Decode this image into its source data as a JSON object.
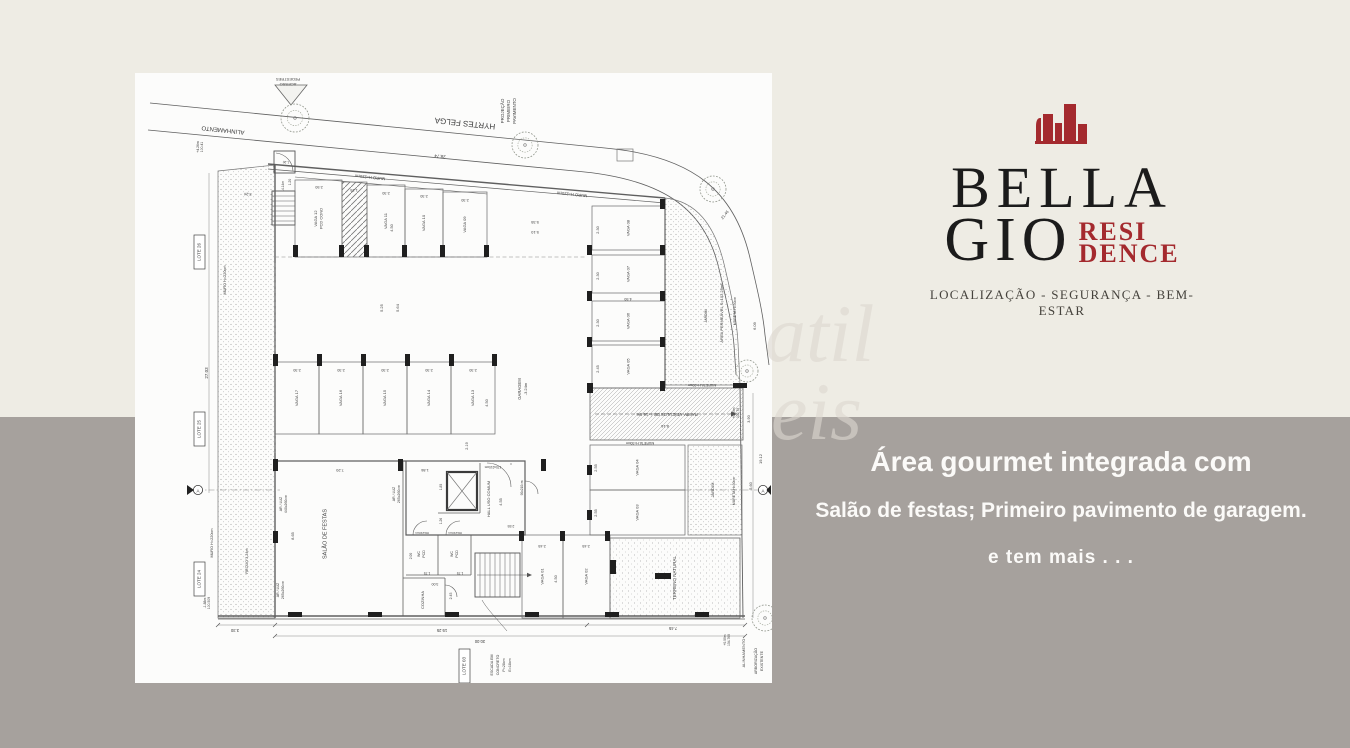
{
  "colors": {
    "bg_top": "#eeece4",
    "bg_bottom": "#a6a19d",
    "accent": "#a42a2e",
    "ink": "#1b1b1b"
  },
  "branding": {
    "name_line1": "BELLA",
    "name_line2": "GIO",
    "suffix_line1": "RESI",
    "suffix_line2": "DENCE",
    "tagline": "LOCALIZAÇÃO - SEGURANÇA - BEM-ESTAR"
  },
  "marketing": {
    "line1": "Área gourmet integrada com",
    "line2": "Salão de festas; Primeiro pavimento de garagem.",
    "line3": "e tem mais . . ."
  },
  "watermark": {
    "part1": "atil",
    "part2": "eis"
  },
  "plan": {
    "street_name": "HYRTES FELGA",
    "stalls": [
      {
        "label": "VAGA 12",
        "label2": "PCD COND",
        "x": 160,
        "y": 107,
        "w": 47,
        "h": 77
      },
      {
        "label": "VAGA 11",
        "x": 232,
        "y": 112,
        "w": 38,
        "h": 72
      },
      {
        "label": "VAGA 10",
        "x": 270,
        "y": 116,
        "w": 38,
        "h": 68
      },
      {
        "label": "VAGA 09",
        "x": 308,
        "y": 119,
        "w": 44,
        "h": 65
      },
      {
        "label": "VAGA 08",
        "x": 457,
        "y": 133,
        "w": 73,
        "h": 44
      },
      {
        "label": "VAGA 07",
        "x": 457,
        "y": 182,
        "w": 73,
        "h": 38
      },
      {
        "label": "VAGA 06",
        "x": 457,
        "y": 228,
        "w": 73,
        "h": 40
      },
      {
        "label": "VAGA 05",
        "x": 457,
        "y": 272,
        "w": 73,
        "h": 43
      },
      {
        "label": "VAGA 17",
        "x": 140,
        "y": 289,
        "w": 44,
        "h": 72
      },
      {
        "label": "VAGA 16",
        "x": 184,
        "y": 289,
        "w": 44,
        "h": 72
      },
      {
        "label": "VAGA 15",
        "x": 228,
        "y": 289,
        "w": 44,
        "h": 72
      },
      {
        "label": "VAGA 14",
        "x": 272,
        "y": 289,
        "w": 44,
        "h": 72
      },
      {
        "label": "VAGA 13",
        "x": 316,
        "y": 289,
        "w": 44,
        "h": 72
      },
      {
        "label": "VAGA 04",
        "x": 455,
        "y": 372,
        "w": 95,
        "h": 45
      },
      {
        "label": "VAGA 03",
        "x": 455,
        "y": 417,
        "w": 95,
        "h": 45
      },
      {
        "label": "VAGA 01",
        "x": 387,
        "y": 462,
        "w": 41,
        "h": 83
      },
      {
        "label": "VAGA 02",
        "x": 428,
        "y": 462,
        "w": 47,
        "h": 83
      }
    ],
    "boxes": [
      {
        "t": "LOTE 26",
        "x": 59,
        "y": 162
      },
      {
        "t": "LOTE 25",
        "x": 59,
        "y": 339
      },
      {
        "t": "LOTE 24",
        "x": 59,
        "y": 489
      },
      {
        "t": "LOTE 03",
        "x": 324,
        "y": 576
      }
    ],
    "labels": [
      {
        "t": "PEDESTRES",
        "x": 153,
        "y": 6,
        "r": 180,
        "s": 4
      },
      {
        "t": "ACESSO",
        "x": 153,
        "y": 11,
        "r": 180,
        "s": 4
      },
      {
        "t": "ALINHAMENTO",
        "x": 88,
        "y": 57,
        "r": 186,
        "s": 6
      },
      {
        "t": "HYRTES FELGA",
        "x": 330,
        "y": 50,
        "r": 186,
        "s": 8
      },
      {
        "t": "28.74",
        "x": 305,
        "y": 83,
        "r": 186,
        "s": 4.5
      },
      {
        "t": "MURO H=220cm",
        "x": 235,
        "y": 104,
        "r": 186,
        "s": 4
      },
      {
        "t": "MURO H=220cm",
        "x": 437,
        "y": 121,
        "r": 186,
        "s": 4
      },
      {
        "t": "PROJEÇÃO",
        "x": 368,
        "y": 38,
        "r": -90,
        "s": 4.5
      },
      {
        "t": "PRIMEIRO",
        "x": 374,
        "y": 38,
        "r": -90,
        "s": 4.5
      },
      {
        "t": "PAVIMENTO",
        "x": 380,
        "y": 38,
        "r": -90,
        "s": 4.5
      },
      {
        "t": "+4.26m",
        "x": 63,
        "y": 74,
        "r": -90,
        "s": 3.4
      },
      {
        "t": "100.41",
        "x": 67,
        "y": 74,
        "r": -90,
        "s": 3.4
      },
      {
        "t": "21.46",
        "x": 590,
        "y": 142,
        "r": -52,
        "s": 4
      },
      {
        "t": "27.03",
        "x": 72,
        "y": 300,
        "r": -90,
        "s": 4.5
      },
      {
        "t": "MURO H=220cm",
        "x": 90,
        "y": 207,
        "r": -90,
        "s": 3.8
      },
      {
        "t": "RECUO 3.24m",
        "x": 112,
        "y": 488,
        "r": -90,
        "s": 3.8
      },
      {
        "t": "MURO H=220cm",
        "x": 77,
        "y": 470,
        "r": -90,
        "s": 3.8
      },
      {
        "t": "-1.88m",
        "x": 70,
        "y": 530,
        "r": -90,
        "s": 3.4
      },
      {
        "t": "100.509",
        "x": 74,
        "y": 530,
        "r": -90,
        "s": 3.4
      },
      {
        "t": "3.24",
        "x": 113,
        "y": 121,
        "r": 186,
        "s": 3.8
      },
      {
        "t": "-4.14m",
        "x": 148,
        "y": 113,
        "r": -90,
        "s": 3.3
      },
      {
        "t": "1.20",
        "x": 155,
        "y": 109,
        "r": -90,
        "s": 3.3
      },
      {
        "t": "1.20",
        "x": 151,
        "y": 89,
        "r": 186,
        "s": 3.3
      },
      {
        "t": "2.50",
        "x": 184,
        "y": 114,
        "r": 180,
        "s": 3.8
      },
      {
        "t": "1.25",
        "x": 219,
        "y": 117,
        "r": 180,
        "s": 3.8
      },
      {
        "t": "2.30",
        "x": 251,
        "y": 120,
        "r": 180,
        "s": 3.8
      },
      {
        "t": "2.30",
        "x": 289,
        "y": 123,
        "r": 180,
        "s": 3.8
      },
      {
        "t": "2.30",
        "x": 330,
        "y": 127,
        "r": 180,
        "s": 3.8
      },
      {
        "t": "4.50",
        "x": 257,
        "y": 155,
        "r": -90,
        "s": 3.8
      },
      {
        "t": "5.35",
        "x": 400,
        "y": 149,
        "r": 180,
        "s": 4
      },
      {
        "t": "5.10",
        "x": 400,
        "y": 159,
        "r": 180,
        "s": 4
      },
      {
        "t": "5.25",
        "x": 247,
        "y": 235,
        "r": -90,
        "s": 4
      },
      {
        "t": "5.64",
        "x": 263,
        "y": 235,
        "r": -90,
        "s": 4
      },
      {
        "t": "GARAGEM",
        "x": 385,
        "y": 316,
        "r": -90,
        "s": 4.2
      },
      {
        "t": "-3.24m",
        "x": 391,
        "y": 316,
        "r": -90,
        "s": 4
      },
      {
        "t": "2.19",
        "x": 332,
        "y": 373,
        "r": -90,
        "s": 3.8
      },
      {
        "t": "2.30",
        "x": 162,
        "y": 297,
        "r": 180,
        "s": 3.8
      },
      {
        "t": "2.30",
        "x": 206,
        "y": 297,
        "r": 180,
        "s": 3.8
      },
      {
        "t": "2.30",
        "x": 250,
        "y": 297,
        "r": 180,
        "s": 3.8
      },
      {
        "t": "2.30",
        "x": 294,
        "y": 297,
        "r": 180,
        "s": 3.8
      },
      {
        "t": "2.30",
        "x": 338,
        "y": 297,
        "r": 180,
        "s": 3.8
      },
      {
        "t": "4.50",
        "x": 352,
        "y": 330,
        "r": -90,
        "s": 3.8
      },
      {
        "t": "2.30",
        "x": 463,
        "y": 157,
        "r": -90,
        "s": 3.8
      },
      {
        "t": "2.30",
        "x": 463,
        "y": 203,
        "r": -90,
        "s": 3.8
      },
      {
        "t": "4.50",
        "x": 493,
        "y": 226,
        "r": 180,
        "s": 3.8
      },
      {
        "t": "2.30",
        "x": 463,
        "y": 250,
        "r": -90,
        "s": 3.8
      },
      {
        "t": "2.45",
        "x": 463,
        "y": 296,
        "r": -90,
        "s": 3.8
      },
      {
        "t": "JARDIM",
        "x": 571,
        "y": 243,
        "r": -90,
        "s": 3.5
      },
      {
        "t": "ÁREA PERMEÁVEL S=102,23m²",
        "x": 587,
        "y": 240,
        "r": -90,
        "s": 4
      },
      {
        "t": "MURETA H=30cm",
        "x": 600,
        "y": 238,
        "r": -90,
        "s": 3.5
      },
      {
        "t": "6.09",
        "x": 620,
        "y": 253,
        "r": -90,
        "s": 4
      },
      {
        "t": "MURETA H=30cm",
        "x": 567,
        "y": 312,
        "r": 180,
        "s": 3.5
      },
      {
        "t": "RAMPA VEÍCULOS DB. i=16,6%",
        "x": 532,
        "y": 341,
        "r": 180,
        "s": 4.2
      },
      {
        "t": "8.16",
        "x": 530,
        "y": 353,
        "r": 180,
        "s": 4
      },
      {
        "t": "+0.00m",
        "x": 599,
        "y": 340,
        "r": -90,
        "s": 3.3
      },
      {
        "t": "102.79",
        "x": 603,
        "y": 340,
        "r": -90,
        "s": 3.3
      },
      {
        "t": "3.90",
        "x": 614,
        "y": 346,
        "r": -90,
        "s": 3.8
      },
      {
        "t": "19.12",
        "x": 626,
        "y": 386,
        "r": -90,
        "s": 4
      },
      {
        "t": "5.60",
        "x": 616,
        "y": 413,
        "r": -90,
        "s": 3.8
      },
      {
        "t": "MURETA H=30cm",
        "x": 505,
        "y": 370,
        "r": 180,
        "s": 3.5
      },
      {
        "t": "2.55",
        "x": 461,
        "y": 395,
        "r": -90,
        "s": 3.8
      },
      {
        "t": "2.55",
        "x": 461,
        "y": 440,
        "r": -90,
        "s": 3.8
      },
      {
        "t": "JARDIM",
        "x": 578,
        "y": 417,
        "r": -90,
        "s": 4
      },
      {
        "t": "MURETA H=30cm",
        "x": 599,
        "y": 418,
        "r": -90,
        "s": 3.5
      },
      {
        "t": "7.20",
        "x": 205,
        "y": 397,
        "r": 180,
        "s": 4
      },
      {
        "t": "1.86",
        "x": 290,
        "y": 397,
        "r": 180,
        "s": 3.8
      },
      {
        "t": "AR / LUZ",
        "x": 146,
        "y": 431,
        "r": -90,
        "s": 3.5
      },
      {
        "t": "440x260cm",
        "x": 151,
        "y": 431,
        "r": -90,
        "s": 3.5
      },
      {
        "t": "8.65",
        "x": 158,
        "y": 463,
        "r": -90,
        "s": 3.8
      },
      {
        "t": "AR / LUZ",
        "x": 143,
        "y": 517,
        "r": -90,
        "s": 3.5
      },
      {
        "t": "265x260cm",
        "x": 148,
        "y": 517,
        "r": -90,
        "s": 3.5
      },
      {
        "t": "AR / LUZ",
        "x": 259,
        "y": 421,
        "r": -90,
        "s": 3.5
      },
      {
        "t": "265x260cm",
        "x": 264,
        "y": 421,
        "r": -90,
        "s": 3.5
      },
      {
        "t": "SALÃO DE FESTAS",
        "x": 190,
        "y": 461,
        "r": -90,
        "s": 5.5
      },
      {
        "t": "1.85",
        "x": 306,
        "y": 414,
        "r": -90,
        "s": 3.3
      },
      {
        "t": "1.26",
        "x": 306,
        "y": 448,
        "r": -90,
        "s": 3.3
      },
      {
        "t": "170x210cm",
        "x": 358,
        "y": 394,
        "r": 180,
        "s": 3.2
      },
      {
        "t": "90x210cm",
        "x": 387,
        "y": 415,
        "r": -90,
        "s": 3.2
      },
      {
        "t": "HALL USO COMUM",
        "x": 354,
        "y": 426,
        "r": -90,
        "s": 4
      },
      {
        "t": "4.55",
        "x": 366,
        "y": 429,
        "r": -90,
        "s": 3.8
      },
      {
        "t": "2.55",
        "x": 376,
        "y": 453,
        "r": 180,
        "s": 3.5
      },
      {
        "t": "80x210cm",
        "x": 287,
        "y": 460,
        "r": 180,
        "s": 3
      },
      {
        "t": "80x210cm",
        "x": 320,
        "y": 460,
        "r": 180,
        "s": 3
      },
      {
        "t": "WC",
        "x": 284,
        "y": 481,
        "r": -90,
        "s": 3.6
      },
      {
        "t": "PCD",
        "x": 289,
        "y": 481,
        "r": -90,
        "s": 3.6
      },
      {
        "t": "WC",
        "x": 317,
        "y": 481,
        "r": -90,
        "s": 3.6
      },
      {
        "t": "PCD",
        "x": 322,
        "y": 481,
        "r": -90,
        "s": 3.6
      },
      {
        "t": "2.00",
        "x": 276,
        "y": 483,
        "r": -90,
        "s": 3.3
      },
      {
        "t": "1.75",
        "x": 292,
        "y": 500,
        "r": 180,
        "s": 3.3
      },
      {
        "t": "1.75",
        "x": 325,
        "y": 500,
        "r": 180,
        "s": 3.3
      },
      {
        "t": "3.00",
        "x": 300,
        "y": 511,
        "r": 180,
        "s": 3.5
      },
      {
        "t": "2.45",
        "x": 316,
        "y": 523,
        "r": -90,
        "s": 3.5
      },
      {
        "t": "COZINHA",
        "x": 288,
        "y": 527,
        "r": -90,
        "s": 4
      },
      {
        "t": "2.45",
        "x": 407,
        "y": 473,
        "r": 180,
        "s": 3.8
      },
      {
        "t": "2.45",
        "x": 451,
        "y": 473,
        "r": 180,
        "s": 3.8
      },
      {
        "t": "4.50",
        "x": 421,
        "y": 506,
        "r": -90,
        "s": 3.8
      },
      {
        "t": "TERRENO NATURAL",
        "x": 540,
        "y": 505,
        "r": -90,
        "s": 4.5
      },
      {
        "t": "19.25",
        "x": 307,
        "y": 557,
        "r": 180,
        "s": 4.2
      },
      {
        "t": "30.00",
        "x": 345,
        "y": 568,
        "r": 180,
        "s": 4.2
      },
      {
        "t": "3.30",
        "x": 100,
        "y": 557,
        "r": 180,
        "s": 4.2
      },
      {
        "t": "7.45",
        "x": 538,
        "y": 555,
        "r": 180,
        "s": 4.2
      },
      {
        "t": "ESCADA EM",
        "x": 357,
        "y": 592,
        "r": -90,
        "s": 3.6
      },
      {
        "t": "CONCRETO",
        "x": 363,
        "y": 592,
        "r": -90,
        "s": 3.6
      },
      {
        "t": "P=28cm",
        "x": 369,
        "y": 592,
        "r": -90,
        "s": 3.6
      },
      {
        "t": "E=18cm",
        "x": 375,
        "y": 592,
        "r": -90,
        "s": 3.6
      },
      {
        "t": "ALINHAMENTO",
        "x": 609,
        "y": 580,
        "r": -90,
        "s": 4
      },
      {
        "t": "ARBORIZAÇÃO",
        "x": 621,
        "y": 588,
        "r": -90,
        "s": 3.6
      },
      {
        "t": "EXISTENTE",
        "x": 627,
        "y": 588,
        "r": -90,
        "s": 3.6
      },
      {
        "t": "+0.09m",
        "x": 590,
        "y": 567,
        "r": -90,
        "s": 3.3
      },
      {
        "t": "104.769",
        "x": 594,
        "y": 567,
        "r": -90,
        "s": 3.3
      },
      {
        "t": "A",
        "x": 63,
        "y": 418.5,
        "r": 0,
        "s": 4.5
      },
      {
        "t": "A",
        "x": 628,
        "y": 418.5,
        "r": 0,
        "s": 4.5
      }
    ],
    "columns": [
      [
        158,
        172,
        5,
        12
      ],
      [
        204,
        172,
        5,
        12
      ],
      [
        229,
        172,
        5,
        12
      ],
      [
        267,
        172,
        5,
        12
      ],
      [
        305,
        172,
        5,
        12
      ],
      [
        349,
        172,
        5,
        12
      ],
      [
        452,
        172,
        5,
        10
      ],
      [
        452,
        218,
        5,
        10
      ],
      [
        452,
        264,
        5,
        10
      ],
      [
        452,
        310,
        5,
        10
      ],
      [
        525,
        126,
        5,
        10
      ],
      [
        525,
        172,
        5,
        10
      ],
      [
        525,
        218,
        5,
        10
      ],
      [
        525,
        264,
        5,
        10
      ],
      [
        525,
        308,
        5,
        10
      ],
      [
        138,
        281,
        5,
        12
      ],
      [
        182,
        281,
        5,
        12
      ],
      [
        226,
        281,
        5,
        12
      ],
      [
        270,
        281,
        5,
        12
      ],
      [
        314,
        281,
        5,
        12
      ],
      [
        357,
        281,
        5,
        12
      ],
      [
        138,
        386,
        5,
        12
      ],
      [
        263,
        386,
        5,
        12
      ],
      [
        406,
        386,
        5,
        12
      ],
      [
        138,
        458,
        5,
        12
      ],
      [
        384,
        458,
        5,
        10
      ],
      [
        425,
        458,
        5,
        10
      ],
      [
        470,
        458,
        5,
        10
      ],
      [
        452,
        392,
        5,
        10
      ],
      [
        452,
        437,
        5,
        10
      ],
      [
        453,
        310,
        5,
        10
      ],
      [
        598,
        310,
        14,
        5
      ],
      [
        475,
        487,
        6,
        14
      ],
      [
        520,
        500,
        16,
        6
      ],
      [
        153,
        539,
        14,
        5
      ],
      [
        233,
        539,
        14,
        5
      ],
      [
        310,
        539,
        14,
        5
      ],
      [
        390,
        539,
        14,
        5
      ],
      [
        470,
        539,
        14,
        5
      ],
      [
        560,
        539,
        14,
        5
      ]
    ],
    "trees": [
      [
        160,
        45,
        14
      ],
      [
        390,
        72,
        13
      ],
      [
        578,
        116,
        13
      ],
      [
        612,
        298,
        11
      ],
      [
        630,
        545,
        13
      ]
    ]
  }
}
